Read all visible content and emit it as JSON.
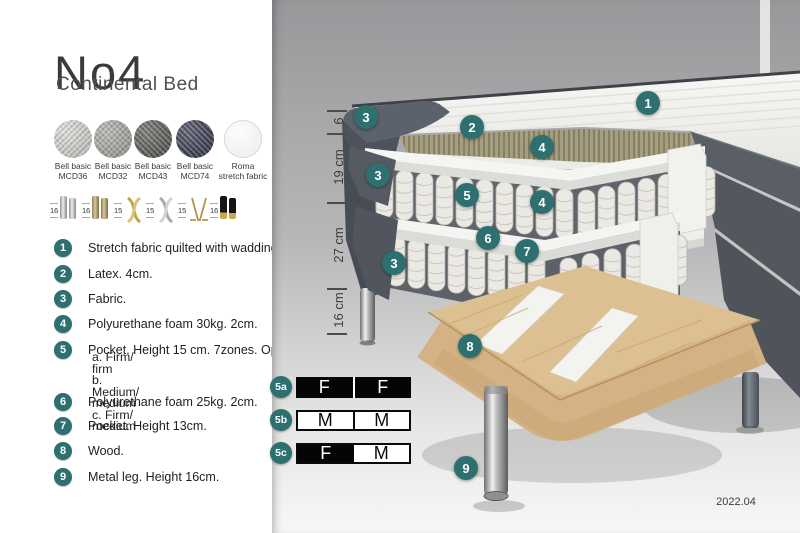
{
  "header": {
    "title": "No4",
    "subtitle": "Continental Bed"
  },
  "fabric_swatches": [
    {
      "label_line1": "Bell basic",
      "label_line2": "MCD36",
      "color": "#d8d6d1",
      "icon": "fabric-swatch"
    },
    {
      "label_line1": "Bell basic",
      "label_line2": "MCD32",
      "color": "#a7a5a1",
      "icon": "fabric-swatch"
    },
    {
      "label_line1": "Bell basic",
      "label_line2": "MCD43",
      "color": "#55544f",
      "icon": "fabric-swatch"
    },
    {
      "label_line1": "Bell basic",
      "label_line2": "MCD74",
      "color": "#2f3349",
      "icon": "fabric-swatch"
    },
    {
      "label_line1": "Roma",
      "label_line2": "stretch fabric",
      "color": "#f4f4f3",
      "icon": "fabric-swatch"
    }
  ],
  "leg_options": [
    {
      "height": "16",
      "icon": "leg-cylinder-chrome-pair-icon"
    },
    {
      "height": "16",
      "icon": "leg-cylinder-brass-pair-icon"
    },
    {
      "height": "15",
      "icon": "leg-twisted-gold-icon"
    },
    {
      "height": "15",
      "icon": "leg-twisted-silver-icon"
    },
    {
      "height": "15",
      "icon": "leg-hairpin-gold-icon"
    },
    {
      "height": "16",
      "icon": "leg-cylinder-black-gold-pair-icon"
    }
  ],
  "parts_list": [
    {
      "num": "1",
      "text": "Stretch fabric quilted with wadding."
    },
    {
      "num": "2",
      "text": "Latex. 4cm."
    },
    {
      "num": "3",
      "text": "Fabric."
    },
    {
      "num": "4",
      "text": "Polyurethane foam 30kg. 2cm."
    },
    {
      "num": "5",
      "text": "Pocket. Height 15 cm. 7zones. Option:",
      "options": [
        "a. Firm/ firm",
        "b. Medium/ medium",
        "c. Firm/ medium"
      ]
    },
    {
      "num": "6",
      "text": "Polyurethane foam 25kg. 2cm."
    },
    {
      "num": "7",
      "text": "Pocket. Height 13cm."
    },
    {
      "num": "8",
      "text": "Wood."
    },
    {
      "num": "9",
      "text": "Metal leg. Height 16cm."
    }
  ],
  "diagram": {
    "callouts": [
      {
        "label": "1"
      },
      {
        "label": "2"
      },
      {
        "label": "3"
      },
      {
        "label": "4"
      },
      {
        "label": "3"
      },
      {
        "label": "5"
      },
      {
        "label": "4"
      },
      {
        "label": "6"
      },
      {
        "label": "7"
      },
      {
        "label": "3"
      },
      {
        "label": "8"
      },
      {
        "label": "9"
      }
    ],
    "dimensions": [
      {
        "label": "6"
      },
      {
        "label": "19 cm"
      },
      {
        "label": "27 cm"
      },
      {
        "label": "16 cm"
      }
    ],
    "version": "2022.04"
  },
  "firmness_table": {
    "rows": [
      {
        "label": "5a",
        "cells": [
          {
            "letter": "F",
            "variant": "dark"
          },
          {
            "letter": "F",
            "variant": "dark"
          }
        ]
      },
      {
        "label": "5b",
        "cells": [
          {
            "letter": "M",
            "variant": "light"
          },
          {
            "letter": "M",
            "variant": "light"
          }
        ]
      },
      {
        "label": "5c",
        "cells": [
          {
            "letter": "F",
            "variant": "dark"
          },
          {
            "letter": "M",
            "variant": "light"
          }
        ]
      }
    ]
  },
  "colors": {
    "accent_teal": "#2e6f70",
    "latex_olive": "#a59e7f",
    "wood": "#dcc091",
    "fabric_dark_gray": "#565b63"
  }
}
